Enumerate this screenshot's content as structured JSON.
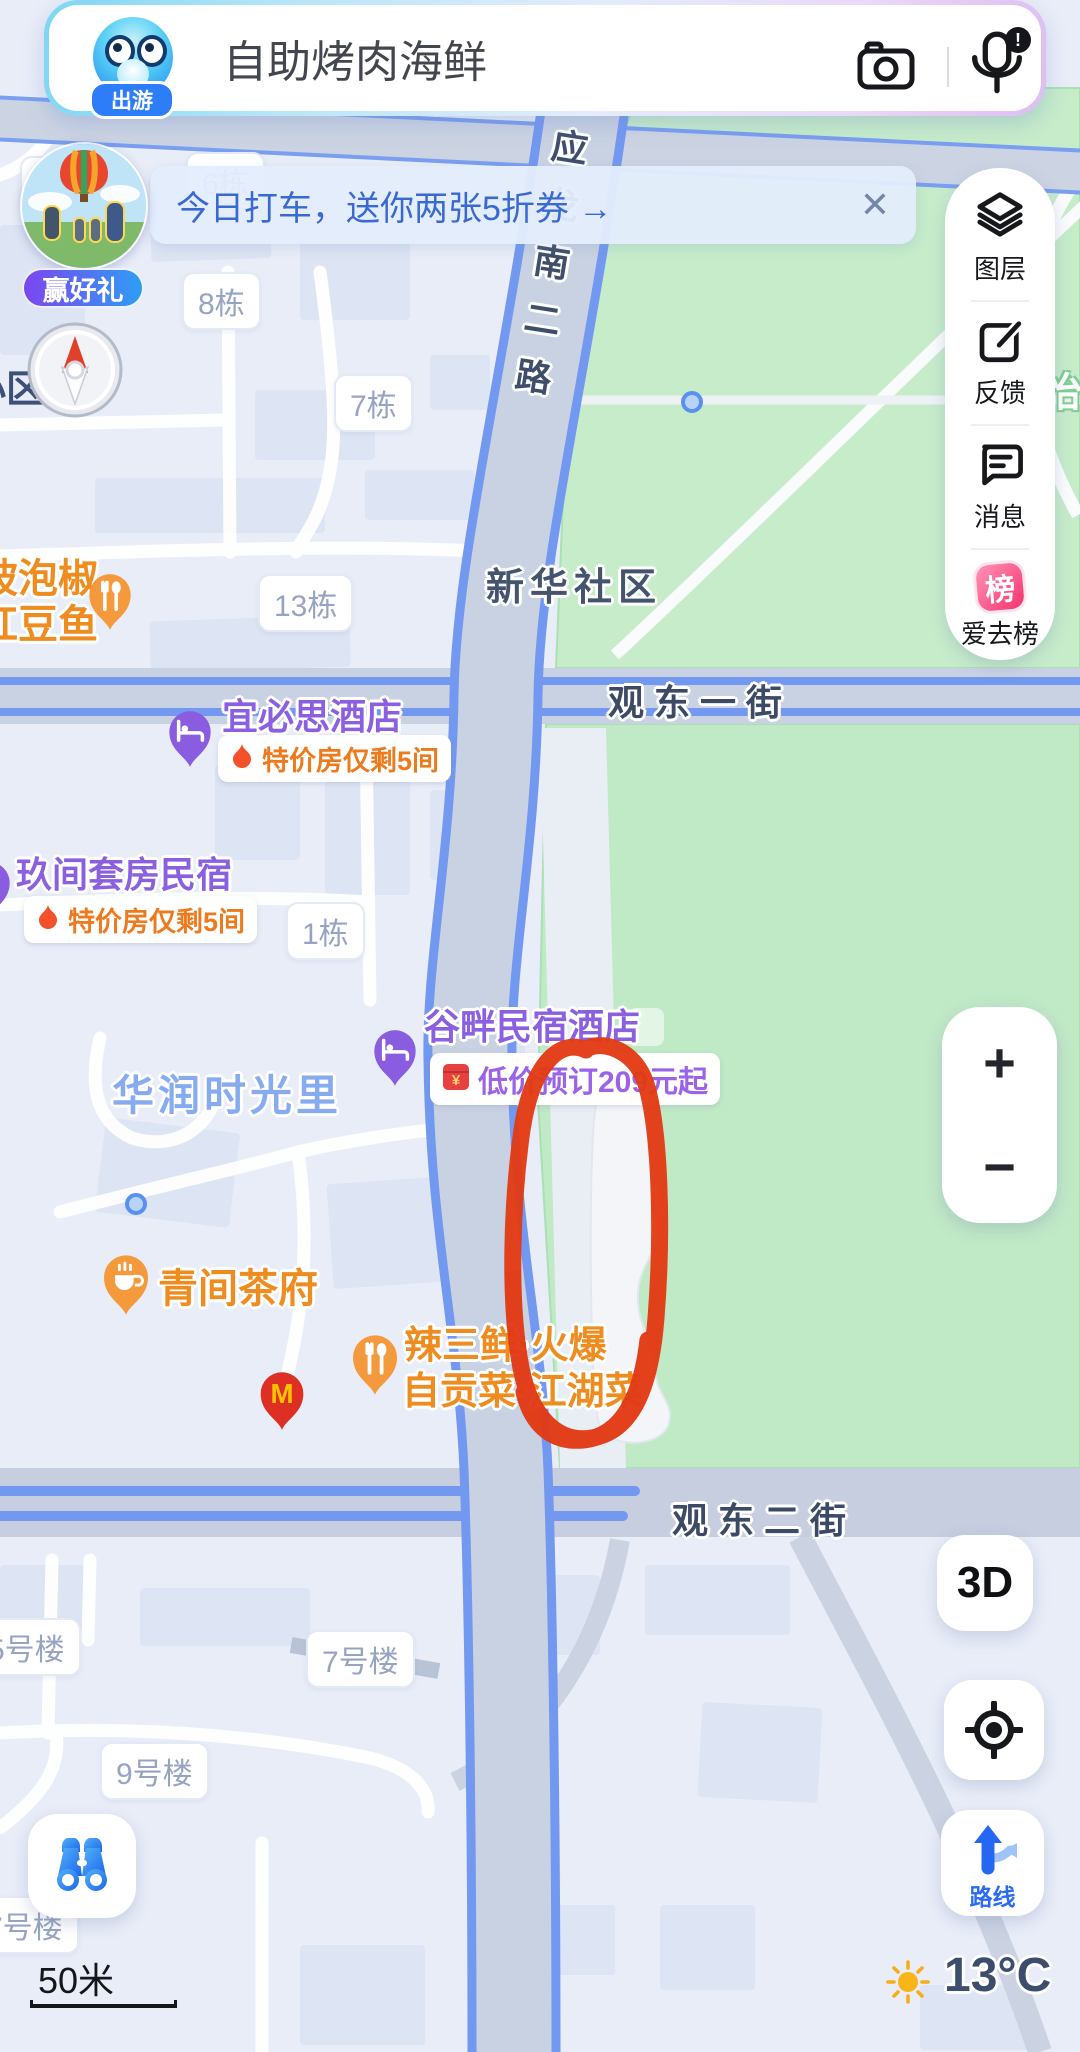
{
  "search_bar": {
    "query": "自助烤肉海鲜",
    "mascot_badge": "出游",
    "mic_badge": "!"
  },
  "banner": {
    "text": "今日打车，送你两张5折券 →",
    "close": "✕"
  },
  "promo": {
    "badge": "赢好礼"
  },
  "toolbar": {
    "items": [
      {
        "label": "图层"
      },
      {
        "label": "反馈"
      },
      {
        "label": "消息"
      },
      {
        "label": "爱去榜",
        "badge": "榜"
      }
    ]
  },
  "map": {
    "road_labels": {
      "vertical_chars": [
        "应",
        "龙",
        "南",
        "二",
        "路"
      ],
      "street1": "观东一街",
      "street2": "观东二街"
    },
    "area_labels": {
      "community": "新华社区",
      "mall": "华润时光里",
      "left_fragment": "小区",
      "right_fragment": "怡"
    },
    "buildings": [
      "5栋",
      "6栋",
      "8栋",
      "7栋",
      "13栋",
      "1栋",
      "5号楼",
      "7号楼",
      "9号楼",
      "7号楼"
    ],
    "pois": {
      "paojiao": {
        "line1": "坡泡椒",
        "line2": "红豆鱼"
      },
      "yibisi": {
        "name": "宜必思酒店",
        "deal": "特价房仅剩5间"
      },
      "jiujian": {
        "name": "玖间套房民宿",
        "deal": "特价房仅剩5间"
      },
      "gupan": {
        "name": "谷畔民宿酒店",
        "deal": "低价预订209元起"
      },
      "qingjian": {
        "name": "青间茶府"
      },
      "lasanxian": {
        "line1": "辣三鲜·火爆",
        "line2": "自贡菜·江湖菜"
      },
      "mcdonalds": {
        "monogram": "M"
      }
    },
    "colors": {
      "park": "#c2e9c7",
      "road_line": "#7398f0",
      "annotation": "#e23a14",
      "accent_blue": "#2a6bf2"
    }
  },
  "controls": {
    "zoom_in": "+",
    "zoom_out": "−",
    "view_3d": "3D",
    "route": "路线",
    "scale": "50米",
    "weather": "13°C"
  }
}
